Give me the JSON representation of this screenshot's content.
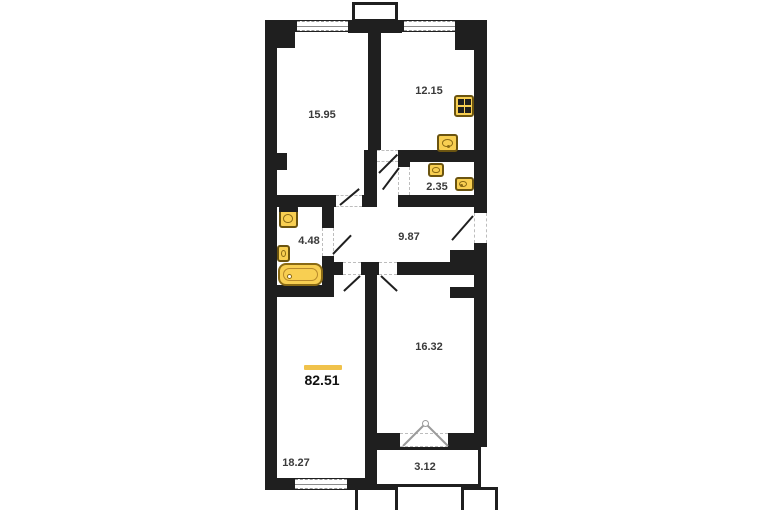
{
  "plan": {
    "total": {
      "area": "82.51"
    },
    "rooms": [
      {
        "name": "living-room",
        "area": "15.95"
      },
      {
        "name": "kitchen",
        "area": "12.15"
      },
      {
        "name": "wc",
        "area": "2.35"
      },
      {
        "name": "bathroom",
        "area": "4.48"
      },
      {
        "name": "hallway",
        "area": "9.87"
      },
      {
        "name": "bedroom",
        "area": "16.32"
      },
      {
        "name": "bedroom-2",
        "area": "18.27"
      },
      {
        "name": "balcony",
        "area": "3.12"
      }
    ],
    "fixtures": [
      "stove",
      "kitchen-sink",
      "wc-sink",
      "wc-toilet",
      "washbasin",
      "toilet",
      "bathtub"
    ],
    "colors": {
      "wall": "#1f1f1f",
      "fixture_fill": "#f8cf52",
      "fixture_border": "#6b5410",
      "accent_line": "#f0c24b",
      "label": "#3a3a3a"
    }
  }
}
